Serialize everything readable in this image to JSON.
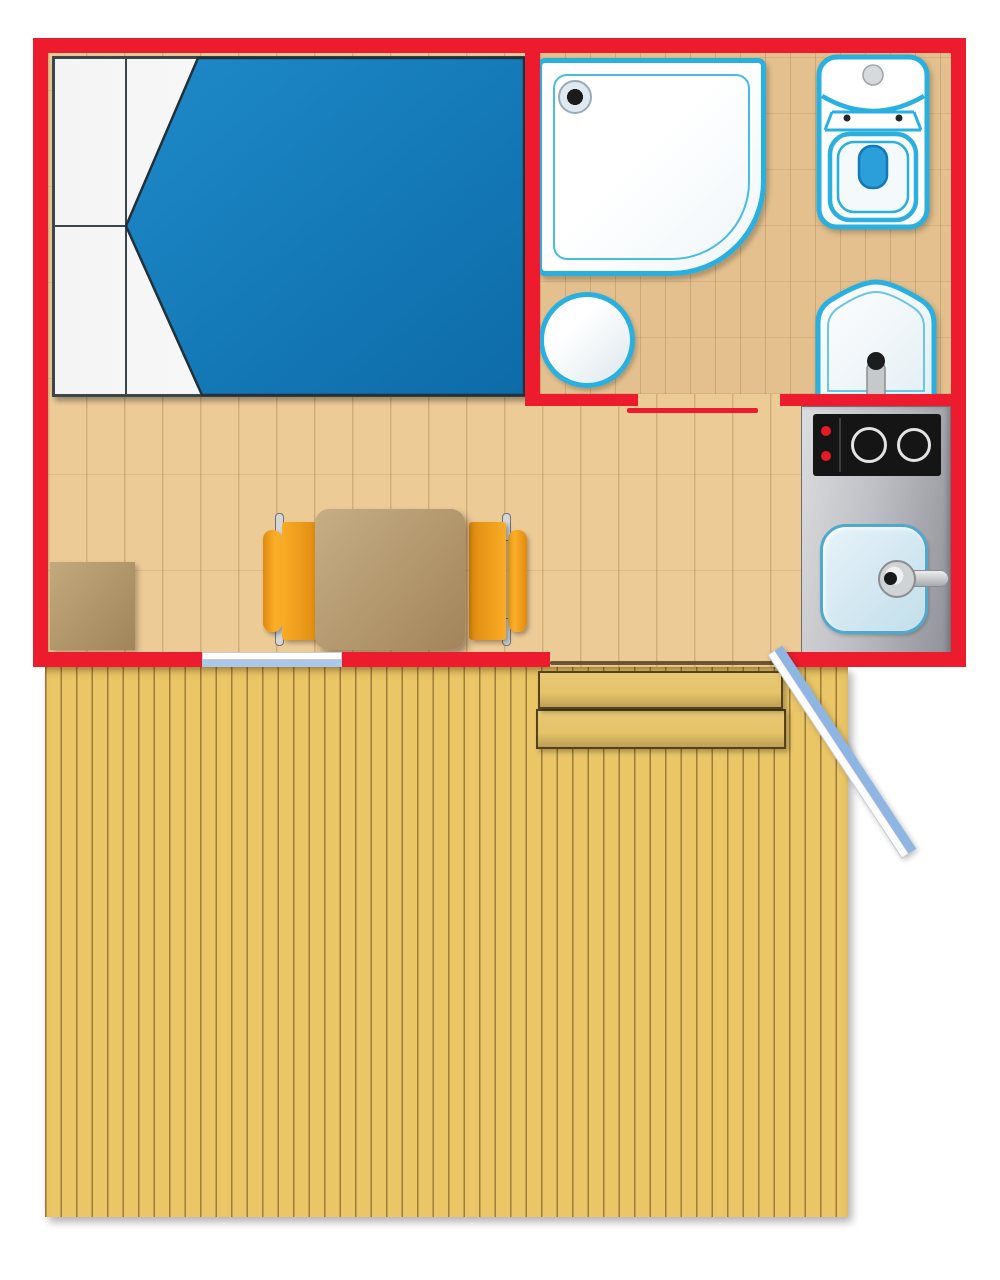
{
  "diagram": {
    "type": "floor-plan",
    "label": "Floor plan of a small cabin: bedroom with double bed, bathroom with corner shower, toilet and washbasin, living-dining area with table, two chairs and stool, kitchenette with two-burner cooktop and sink, window, entry door opening onto a large wooden deck with two steps",
    "rooms": [
      {
        "id": "bedroom",
        "objects": [
          "double-bed",
          "pillows",
          "blue-duvet"
        ]
      },
      {
        "id": "bathroom",
        "objects": [
          "corner-shower-tray",
          "shower-drain",
          "round-bath-mat",
          "toilet",
          "washbasin",
          "sliding-door"
        ]
      },
      {
        "id": "living-kitchen",
        "objects": [
          "dining-table",
          "chair-left",
          "chair-right",
          "stool",
          "kitchen-counter",
          "cooktop-two-burners",
          "kitchen-sink",
          "window",
          "entry-door"
        ]
      },
      {
        "id": "deck",
        "objects": [
          "wood-plank-deck",
          "step-upper",
          "step-lower",
          "open-door-leaf"
        ]
      }
    ]
  },
  "colors": {
    "wall": "#EC1B2D",
    "floor_interior": "#EDCB97",
    "floor_bath": "#E3C08D",
    "deck": "#EAC667",
    "step": "#E5C369",
    "bed_blue_1": "#1E8AC9",
    "bed_blue_2": "#0D6BA8",
    "fixture_cyan": "#2AB0DF",
    "toilet_water": "#2B9FD9",
    "counter_1": "#DCDDE0",
    "counter_2": "#8F9198",
    "cooktop": "#151515",
    "knob_red": "#E61A24",
    "sink_blue_1": "#E7F3F9",
    "sink_blue_2": "#C2DEEB",
    "sink_border": "#4FA9CC",
    "chair_orange_1": "#F9AC25",
    "chair_orange_2": "#E08A10",
    "table_brown_1": "#C6AE85",
    "table_brown_2": "#A3845A",
    "stool_brown_1": "#C3A97E",
    "stool_brown_2": "#A0845A",
    "door_leaf_blue": "#8FB5E3",
    "window_blue": "#A9C8EA",
    "metal_gray": "#D4D6D8"
  }
}
